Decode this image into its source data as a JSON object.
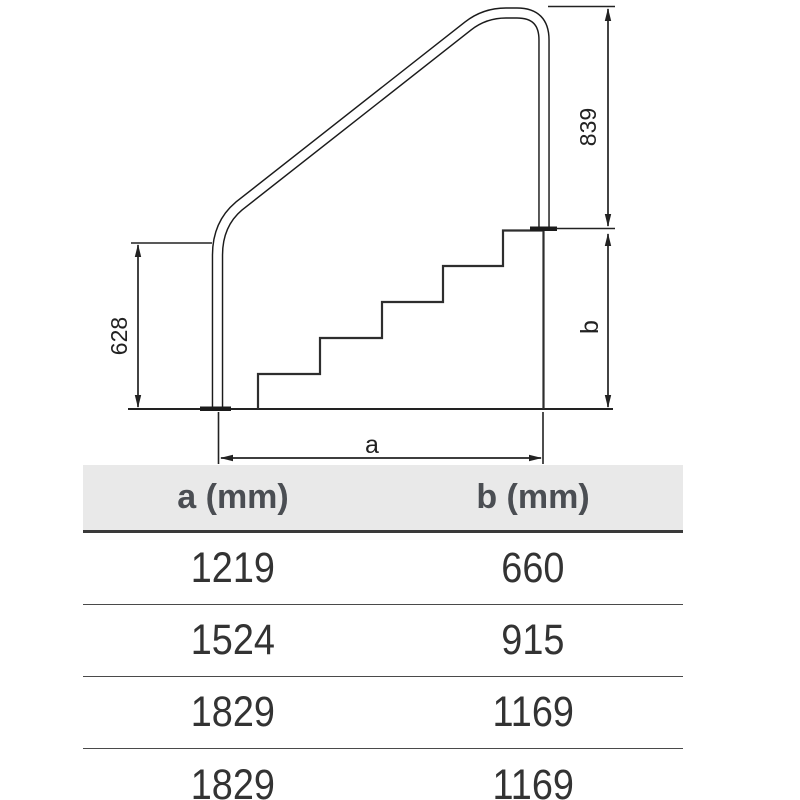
{
  "diagram": {
    "labels": {
      "rail_height": "839",
      "left_post_height": "628",
      "base_width": "a",
      "stair_height": "b"
    }
  },
  "table": {
    "headers": [
      "a (mm)",
      "b (mm)"
    ],
    "rows": [
      [
        "1219",
        "660"
      ],
      [
        "1524",
        "915"
      ],
      [
        "1829",
        "1169"
      ],
      [
        "1829",
        "1169"
      ]
    ]
  },
  "colors": {
    "line": "#222222",
    "stair_line": "#2e2e2e",
    "header_bg": "#e9e9e9",
    "header_text": "#4b4e53",
    "value_text": "#333333"
  }
}
